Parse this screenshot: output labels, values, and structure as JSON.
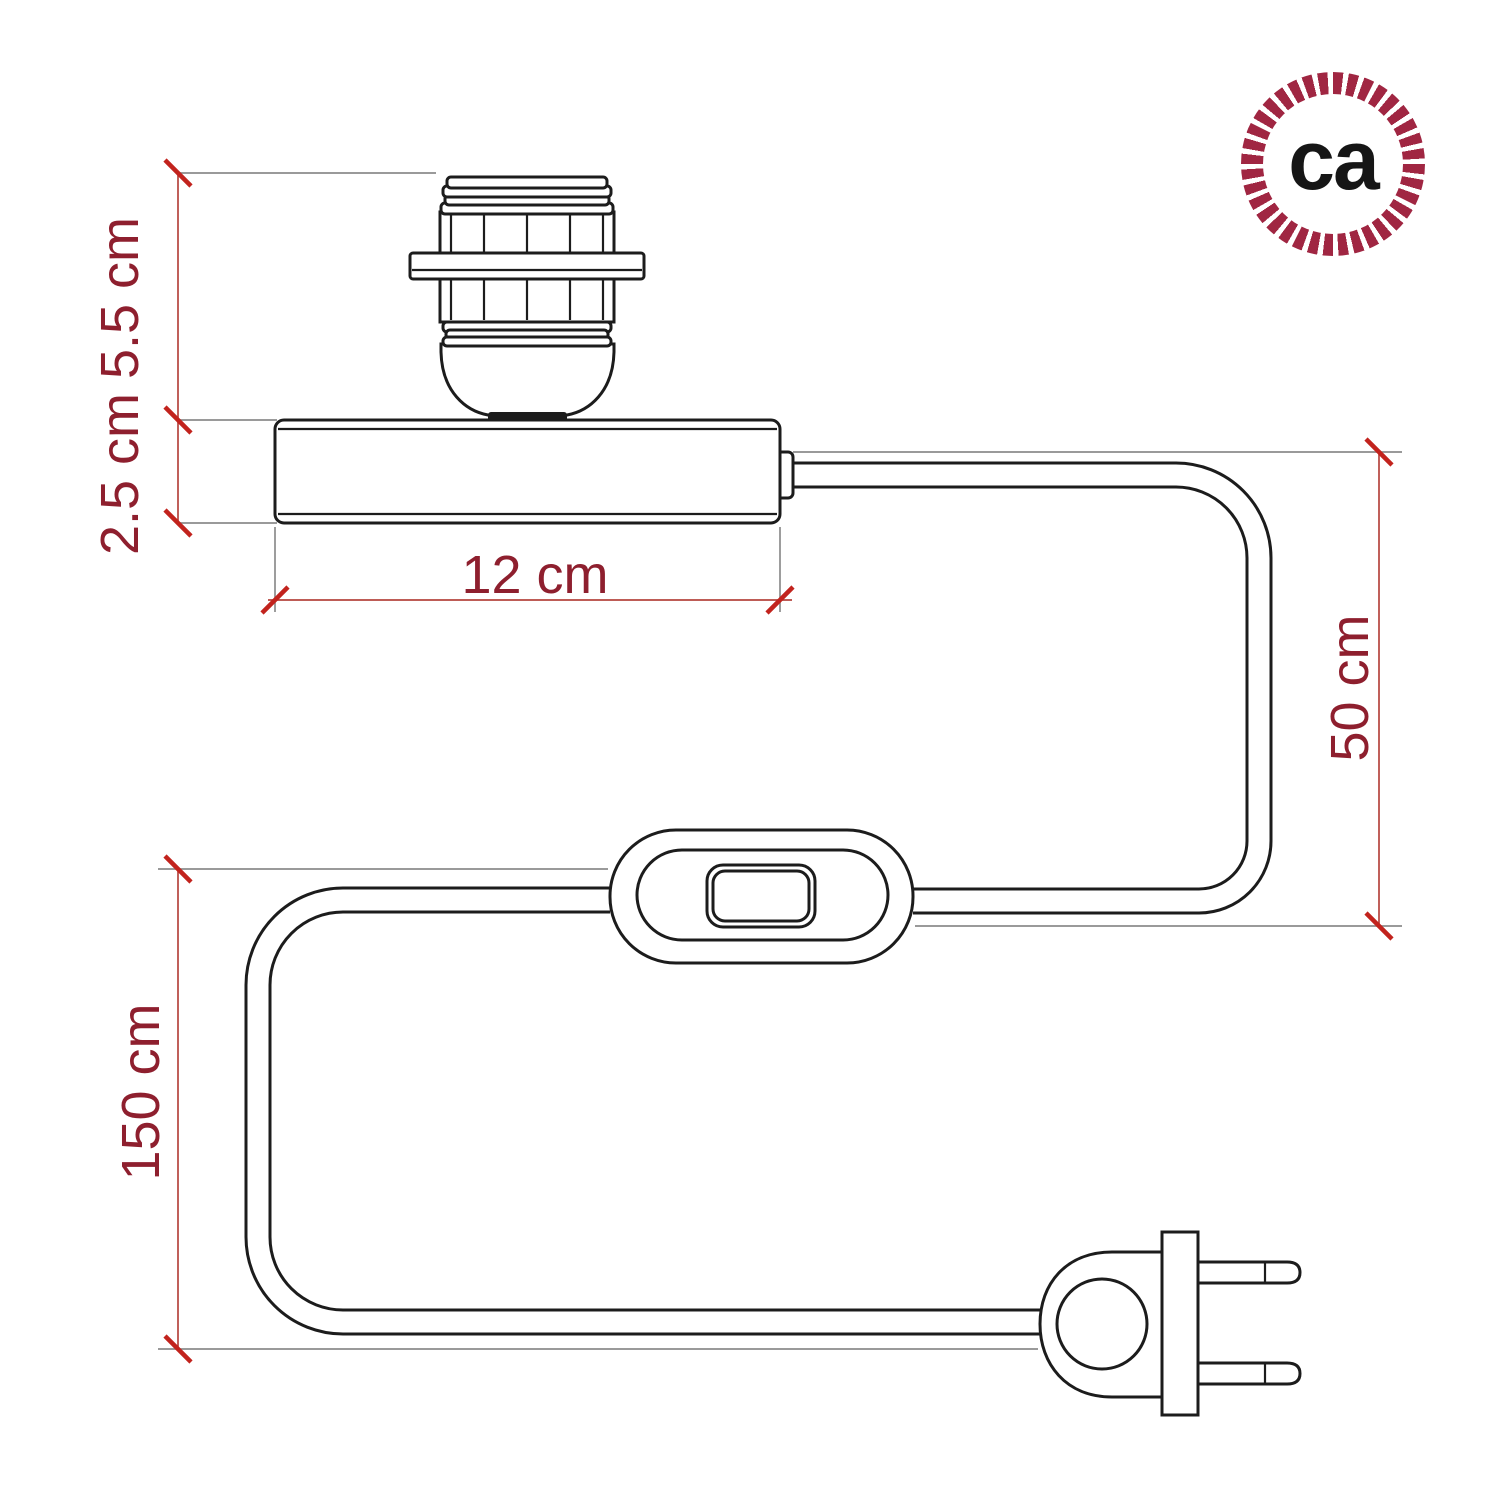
{
  "diagram": {
    "labels": {
      "socket_height": "5.5 cm",
      "base_height": "2.5 cm",
      "base_length": "12 cm",
      "base_to_switch_cable": "50 cm",
      "total_cable": "150 cm"
    }
  },
  "logo": {
    "text": "ca"
  },
  "colors": {
    "ink": "#1c1c1c",
    "brand": "#a02642",
    "dim-text": "#8e1f2e",
    "dim-line": "#b5443e",
    "ext-line": "#8c8c8c",
    "tick": "#c2231d",
    "bg": "#ffffff"
  }
}
